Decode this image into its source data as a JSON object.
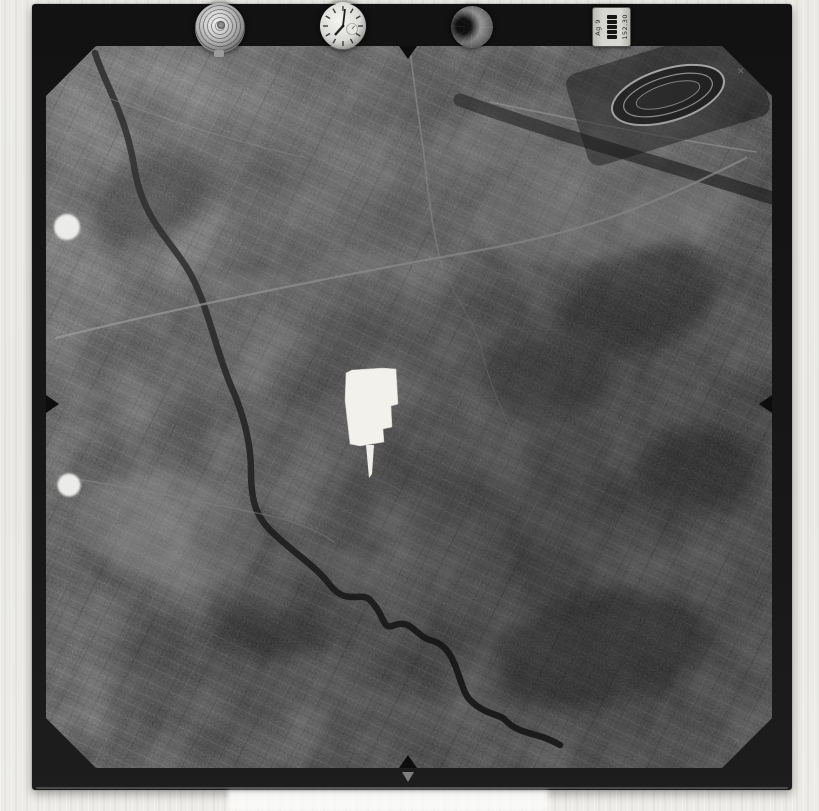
{
  "instrument_panel": {
    "altimeter_icon": "concentric-rings-dial",
    "clock_icon": "analog-clock-dial",
    "secondary_dial_icon": "dark-gauge-dial",
    "data_plate": {
      "line_a": "Ag 9",
      "line_b": "152.30",
      "counter_segments": 5,
      "counter_icon": "digit-counter-stack"
    }
  },
  "fiducials": {
    "corner_mark": "✕",
    "edge_notch_icon": "triangle-notch",
    "bottom_border_arrow_icon": "down-arrow"
  },
  "photo_features": {
    "mask_patch_icon": "white-censor-patch",
    "punch_hole_icon": "white-punch-hole",
    "racetrack_icon": "oval-racetrack",
    "river_icon": "meandering-river",
    "road_icon": "light-road-line"
  },
  "colors": {
    "page_bg": "#eae9e5",
    "film_black": "#171717",
    "photo_base": "#333333",
    "mask_patch": "#f2f1ec",
    "road_gray": "#949494"
  }
}
